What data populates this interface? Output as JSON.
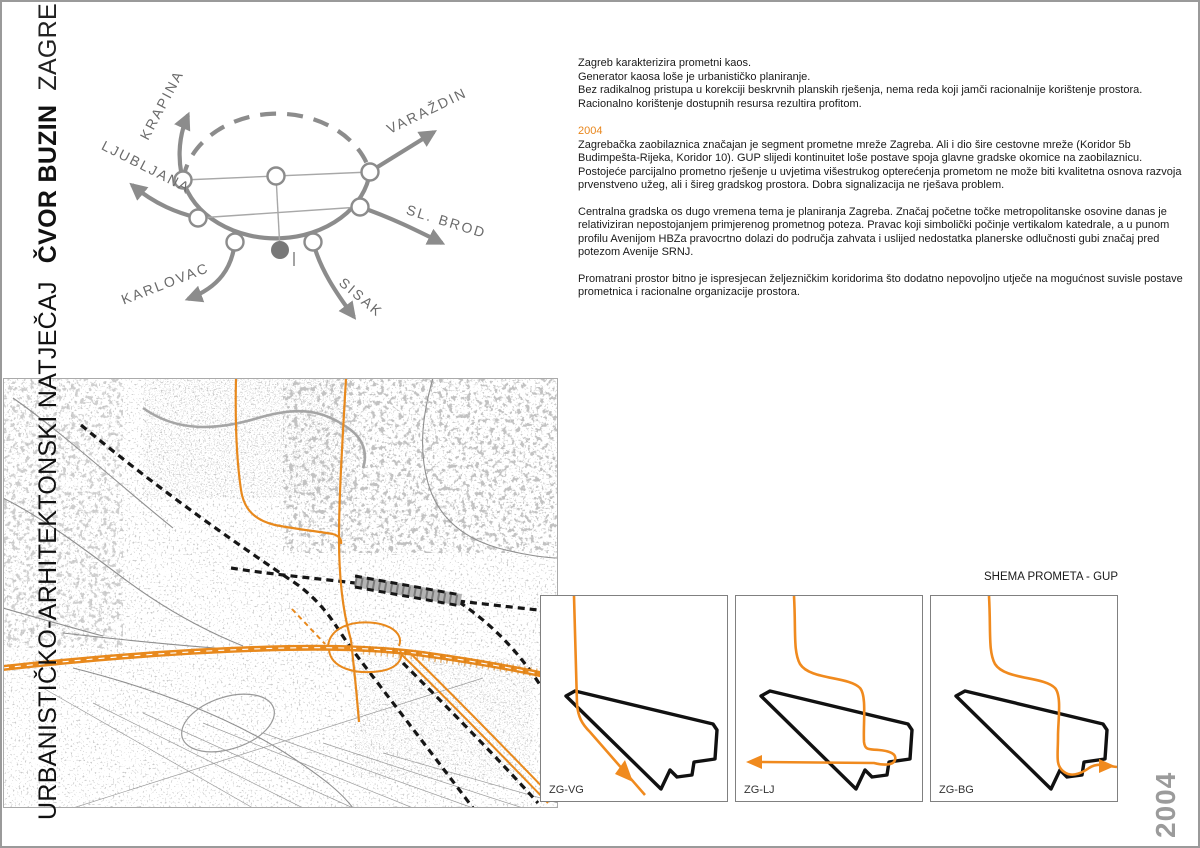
{
  "colors": {
    "accent_orange": "#E8891D",
    "heading_orange": "#E8861C",
    "diagram_gray": "#8c8c8c",
    "year_gray": "#9b9b9b",
    "railway_black": "#161616"
  },
  "sidebar_title": {
    "competition": "URBANISTIČKO-ARHITEKTONSKI NATJEČAJ",
    "project": "ČVOR BUZIN",
    "city": "ZAGREB"
  },
  "year_vertical": "2004",
  "schematic": {
    "labels": [
      "KRAPINA",
      "VARAŽDIN",
      "LJUBLJANA",
      "SL. BROD",
      "KARLOVAC",
      "SISAK"
    ]
  },
  "text_block": {
    "intro_lines": [
      "Zagreb karakterizira prometni kaos.",
      "Generator kaosa loše je urbanističko planiranje.",
      "Bez radikalnog pristupa u korekciji beskrvnih planskih rješenja, nema reda koji jamči racionalnije korištenje prostora.",
      "Racionalno korištenje dostupnih resursa rezultira profitom."
    ],
    "year_heading": "2004",
    "p1_lines": [
      "Zagrebačka zaobilaznica značajan je segment prometne mreže Zagreba. Ali i dio šire cestovne mreže (Koridor 5b",
      "Budimpešta-Rijeka, Koridor 10). GUP slijedi kontinuitet loše postave spoja glavne gradske okomice na zaobilaznicu.",
      "Postojeće parcijalno prometno rješenje u uvjetima višestrukog opterećenja prometom ne može biti kvalitetna osnova razvoja",
      "prvenstveno užeg, ali i šireg gradskog prostora. Dobra signalizacija ne rješava problem."
    ],
    "p2_lines": [
      "Centralna gradska os dugo vremena tema je planiranja Zagreba. Značaj početne točke metropolitanske osovine danas je",
      "relativiziran nepostojanjem primjerenog prometnog poteza. Pravac koji simbolički počinje vertikalom katedrale, a u punom",
      "profilu Avenijom HBZa pravocrtno dolazi do područja zahvata i uslijed nedostatka planerske odlučnosti gubi  značaj pred",
      "potezom Avenije SRNJ."
    ],
    "p3_lines": [
      "Promatrani prostor bitno je ispresjecan željezničkim koridorima što dodatno nepovoljno utječe na mogućnost suvisle postave",
      "prometnica i racionalne organizacije prostora."
    ]
  },
  "schemes": {
    "heading": "SHEMA PROMETA - GUP",
    "items": [
      {
        "label": "ZG-VG"
      },
      {
        "label": "ZG-LJ"
      },
      {
        "label": "ZG-BG"
      }
    ]
  }
}
